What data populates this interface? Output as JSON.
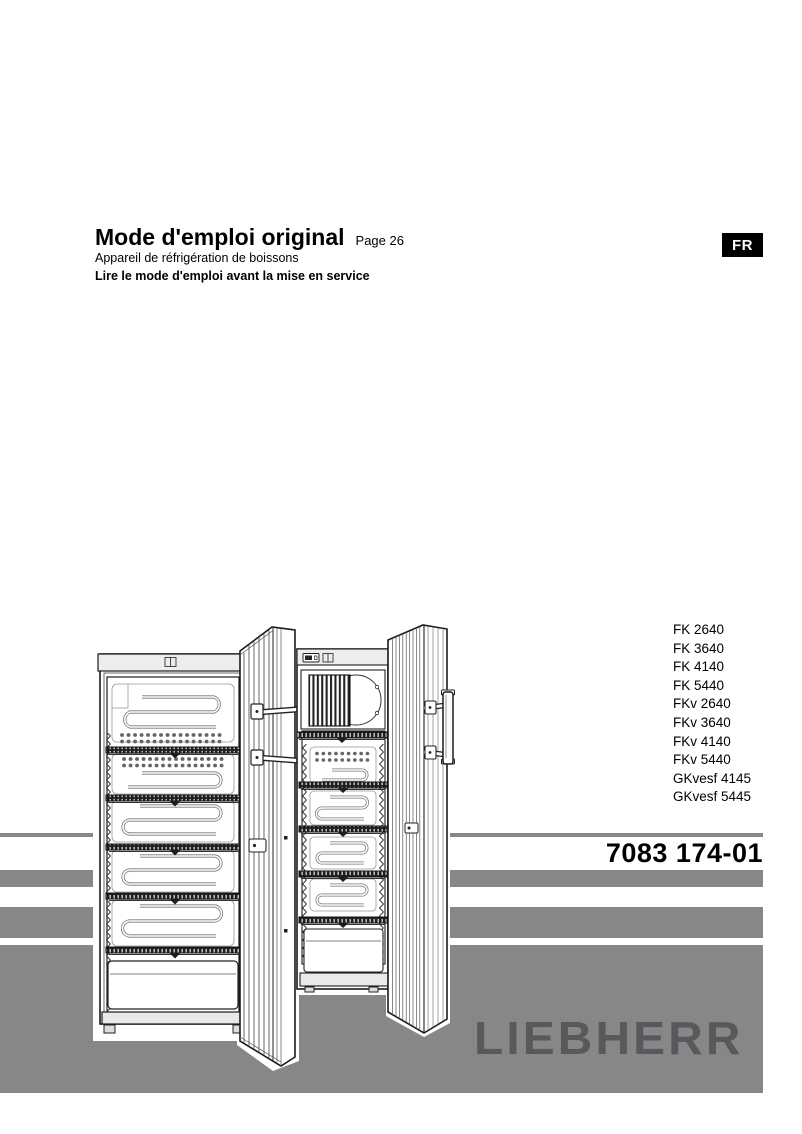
{
  "header": {
    "title": "Mode d'emploi original",
    "page_ref": "Page 26",
    "subtitle": "Appareil de réfrigération de boissons",
    "notice": "Lire le mode d'emploi avant la mise en service"
  },
  "language_badge": "FR",
  "models": [
    "FK 2640",
    "FK 3640",
    "FK 4140",
    "FK 5440",
    "FKv 2640",
    "FKv 3640",
    "FKv 4140",
    "FKv 5440",
    "GKvesf 4145",
    "GKvesf 5445"
  ],
  "document_number": "7083 174-01",
  "brand_logo": "LIEBHERR",
  "figure": {
    "icon": "refrigerators-illustration",
    "alt": "Two upright beverage refrigerators with open doors"
  },
  "colors": {
    "band_gray": "#87878a",
    "logo_gray": "#59595b",
    "badge_bg": "#000000",
    "badge_text": "#ffffff"
  }
}
